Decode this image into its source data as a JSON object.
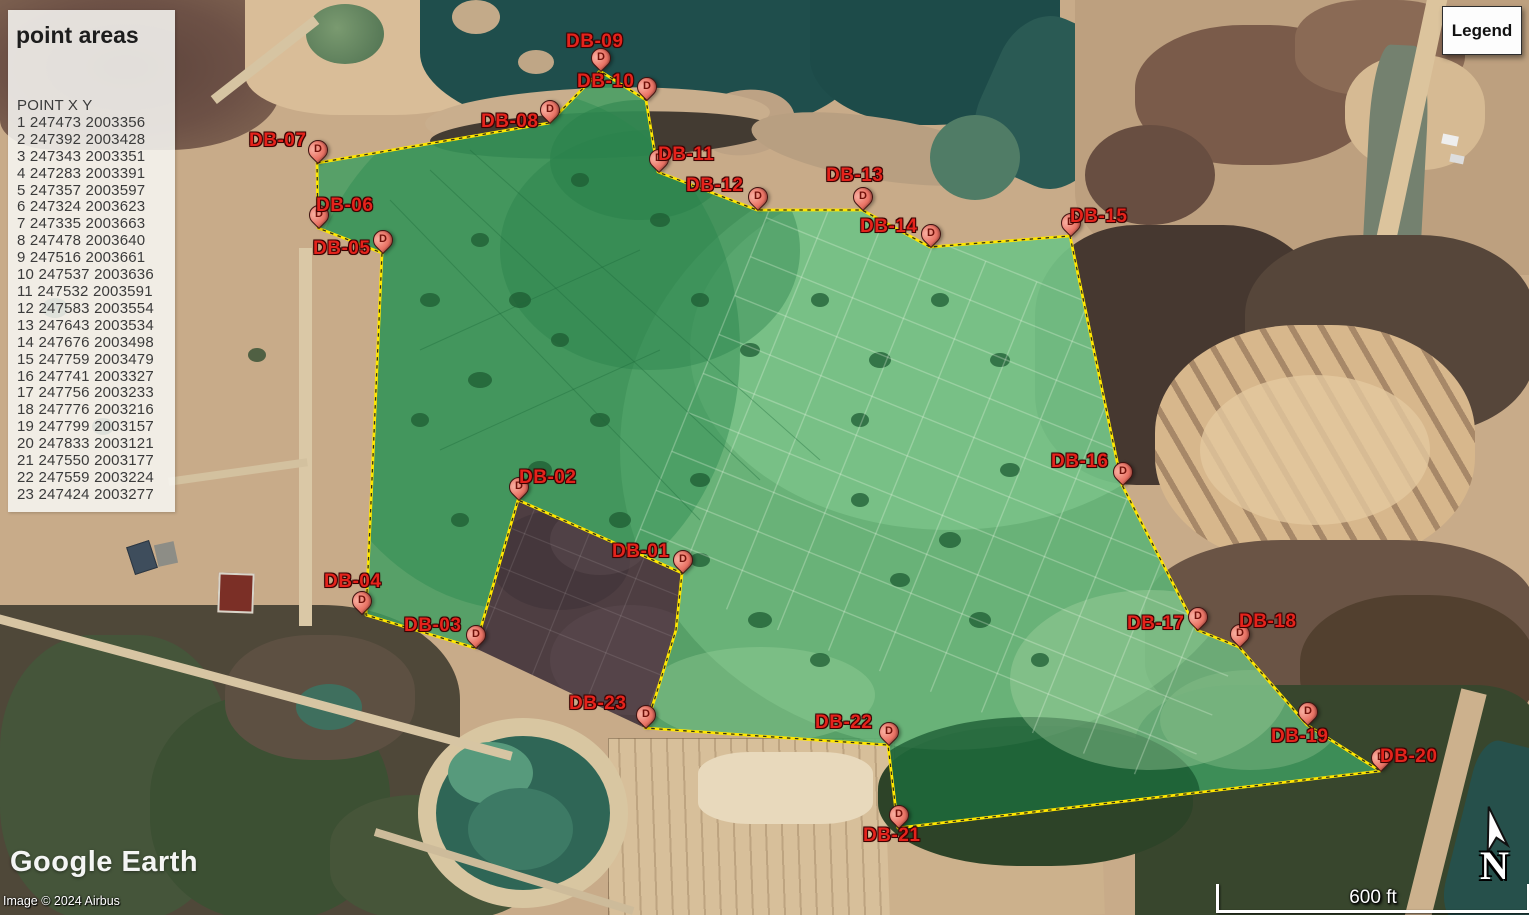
{
  "panel": {
    "title": "point areas",
    "header": "POINT X Y",
    "points": [
      {
        "n": 1,
        "x": 247473,
        "y": 2003356
      },
      {
        "n": 2,
        "x": 247392,
        "y": 2003428
      },
      {
        "n": 3,
        "x": 247343,
        "y": 2003351
      },
      {
        "n": 4,
        "x": 247283,
        "y": 2003391
      },
      {
        "n": 5,
        "x": 247357,
        "y": 2003597
      },
      {
        "n": 6,
        "x": 247324,
        "y": 2003623
      },
      {
        "n": 7,
        "x": 247335,
        "y": 2003663
      },
      {
        "n": 8,
        "x": 247478,
        "y": 2003640
      },
      {
        "n": 9,
        "x": 247516,
        "y": 2003661
      },
      {
        "n": 10,
        "x": 247537,
        "y": 2003636
      },
      {
        "n": 11,
        "x": 247532,
        "y": 2003591
      },
      {
        "n": 12,
        "x": 247583,
        "y": 2003554
      },
      {
        "n": 13,
        "x": 247643,
        "y": 2003534
      },
      {
        "n": 14,
        "x": 247676,
        "y": 2003498
      },
      {
        "n": 15,
        "x": 247759,
        "y": 2003479
      },
      {
        "n": 16,
        "x": 247741,
        "y": 2003327
      },
      {
        "n": 17,
        "x": 247756,
        "y": 2003233
      },
      {
        "n": 18,
        "x": 247776,
        "y": 2003216
      },
      {
        "n": 19,
        "x": 247799,
        "y": 2003157
      },
      {
        "n": 20,
        "x": 247833,
        "y": 2003121
      },
      {
        "n": 21,
        "x": 247550,
        "y": 2003177
      },
      {
        "n": 22,
        "x": 247559,
        "y": 2003224
      },
      {
        "n": 23,
        "x": 247424,
        "y": 2003277
      }
    ]
  },
  "legend_button_label": "Legend",
  "marker_letter": "D",
  "markers": [
    {
      "id": "DB-01",
      "pin": [
        682,
        573
      ],
      "label": [
        612,
        541
      ]
    },
    {
      "id": "DB-02",
      "pin": [
        518,
        500
      ],
      "label": [
        519,
        467
      ]
    },
    {
      "id": "DB-03",
      "pin": [
        475,
        648
      ],
      "label": [
        404,
        615
      ]
    },
    {
      "id": "DB-04",
      "pin": [
        361,
        614
      ],
      "label": [
        324,
        571
      ]
    },
    {
      "id": "DB-05",
      "pin": [
        382,
        253
      ],
      "label": [
        313,
        238
      ]
    },
    {
      "id": "DB-06",
      "pin": [
        318,
        228
      ],
      "label": [
        316,
        195
      ]
    },
    {
      "id": "DB-07",
      "pin": [
        317,
        163
      ],
      "label": [
        249,
        130
      ]
    },
    {
      "id": "DB-08",
      "pin": [
        549,
        123
      ],
      "label": [
        481,
        111
      ]
    },
    {
      "id": "DB-09",
      "pin": [
        600,
        71
      ],
      "label": [
        566,
        31
      ]
    },
    {
      "id": "DB-10",
      "pin": [
        646,
        100
      ],
      "label": [
        577,
        71
      ]
    },
    {
      "id": "DB-11",
      "pin": [
        658,
        172
      ],
      "label": [
        658,
        144
      ]
    },
    {
      "id": "DB-12",
      "pin": [
        757,
        210
      ],
      "label": [
        686,
        175
      ]
    },
    {
      "id": "DB-13",
      "pin": [
        862,
        210
      ],
      "label": [
        826,
        165
      ]
    },
    {
      "id": "DB-14",
      "pin": [
        930,
        247
      ],
      "label": [
        860,
        216
      ]
    },
    {
      "id": "DB-15",
      "pin": [
        1070,
        236
      ],
      "label": [
        1070,
        206
      ]
    },
    {
      "id": "DB-16",
      "pin": [
        1122,
        485
      ],
      "label": [
        1051,
        451
      ]
    },
    {
      "id": "DB-17",
      "pin": [
        1197,
        630
      ],
      "label": [
        1127,
        613
      ]
    },
    {
      "id": "DB-18",
      "pin": [
        1239,
        647
      ],
      "label": [
        1239,
        611
      ]
    },
    {
      "id": "DB-19",
      "pin": [
        1307,
        725
      ],
      "label": [
        1271,
        726
      ]
    },
    {
      "id": "DB-20",
      "pin": [
        1380,
        771
      ],
      "label": [
        1380,
        746
      ]
    },
    {
      "id": "DB-21",
      "pin": [
        898,
        828
      ],
      "label": [
        863,
        825
      ]
    },
    {
      "id": "DB-22",
      "pin": [
        888,
        745
      ],
      "label": [
        815,
        712
      ]
    },
    {
      "id": "DB-23",
      "pin": [
        645,
        728
      ],
      "label": [
        569,
        693
      ]
    }
  ],
  "polygon": {
    "outline": [
      [
        317,
        163
      ],
      [
        549,
        123
      ],
      [
        600,
        71
      ],
      [
        646,
        100
      ],
      [
        658,
        172
      ],
      [
        757,
        210
      ],
      [
        862,
        210
      ],
      [
        930,
        247
      ],
      [
        1070,
        236
      ],
      [
        1122,
        485
      ],
      [
        1197,
        630
      ],
      [
        1239,
        647
      ],
      [
        1307,
        725
      ],
      [
        1380,
        771
      ],
      [
        898,
        828
      ],
      [
        888,
        745
      ],
      [
        645,
        728
      ],
      [
        656,
        695
      ],
      [
        676,
        630
      ],
      [
        682,
        573
      ],
      [
        518,
        500
      ],
      [
        475,
        648
      ],
      [
        366,
        615
      ],
      [
        382,
        253
      ],
      [
        318,
        228
      ]
    ],
    "excluded": [
      [
        518,
        500
      ],
      [
        682,
        573
      ],
      [
        676,
        630
      ],
      [
        656,
        695
      ],
      [
        645,
        728
      ],
      [
        475,
        648
      ]
    ],
    "fill_color": "#3e9e60",
    "outline_color": "#ffe600"
  },
  "scale": {
    "text": "600 ft"
  },
  "compass_letter": "N",
  "logo_text": "Google Earth",
  "attribution": "Image © 2024 Airbus",
  "colors": {
    "marker_fill": "#ea7668",
    "marker_label": "#e4231c",
    "water": "#1f4e4c",
    "panel_bg": "#f8f8f5"
  }
}
